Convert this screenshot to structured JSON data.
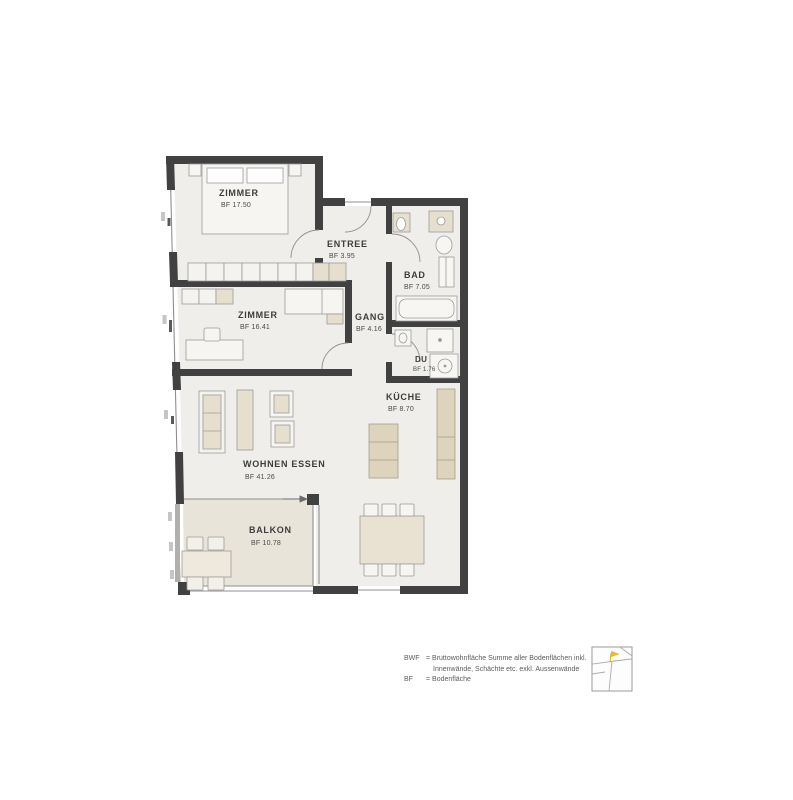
{
  "page": {
    "background": "#ffffff"
  },
  "plan": {
    "type": "apartment-floorplan",
    "rooms": [
      {
        "id": "zimmer-1",
        "name": "ZIMMER",
        "area": "BF 17.50"
      },
      {
        "id": "entree",
        "name": "ENTREE",
        "area": "BF 3.95"
      },
      {
        "id": "bad",
        "name": "BAD",
        "area": "BF 7.05"
      },
      {
        "id": "zimmer-2",
        "name": "ZIMMER",
        "area": "BF 16.41"
      },
      {
        "id": "gang",
        "name": "GANG",
        "area": "BF 4.16"
      },
      {
        "id": "du",
        "name": "DU",
        "area": "BF 1.76"
      },
      {
        "id": "kueche",
        "name": "KÜCHE",
        "area": "BF 8.70"
      },
      {
        "id": "wohnen-essen",
        "name": "WOHNEN ESSEN",
        "area": "BF 41.26"
      },
      {
        "id": "balkon",
        "name": "BALKON",
        "area": "BF 10.78"
      }
    ],
    "colors": {
      "wall": "#414141",
      "floor": "#efeeeb",
      "balcony_floor": "#e9e4d9",
      "furniture_beige": "#e7dfcd",
      "furniture_dark_beige": "#ded4bd",
      "line_gray": "#909090",
      "marker_yellow": "#e9bb1d"
    }
  },
  "legend": {
    "entries": [
      {
        "term": "BWF",
        "definition": "= Bruttowohnfläche Summe aller Bodenflächen inkl.",
        "definition2": "Innenwände, Schächte etc. exkl. Aussenwände"
      },
      {
        "term": "BF",
        "definition": "= Bodenfläche",
        "definition2": ""
      }
    ],
    "icon": "site-plan-icon"
  }
}
